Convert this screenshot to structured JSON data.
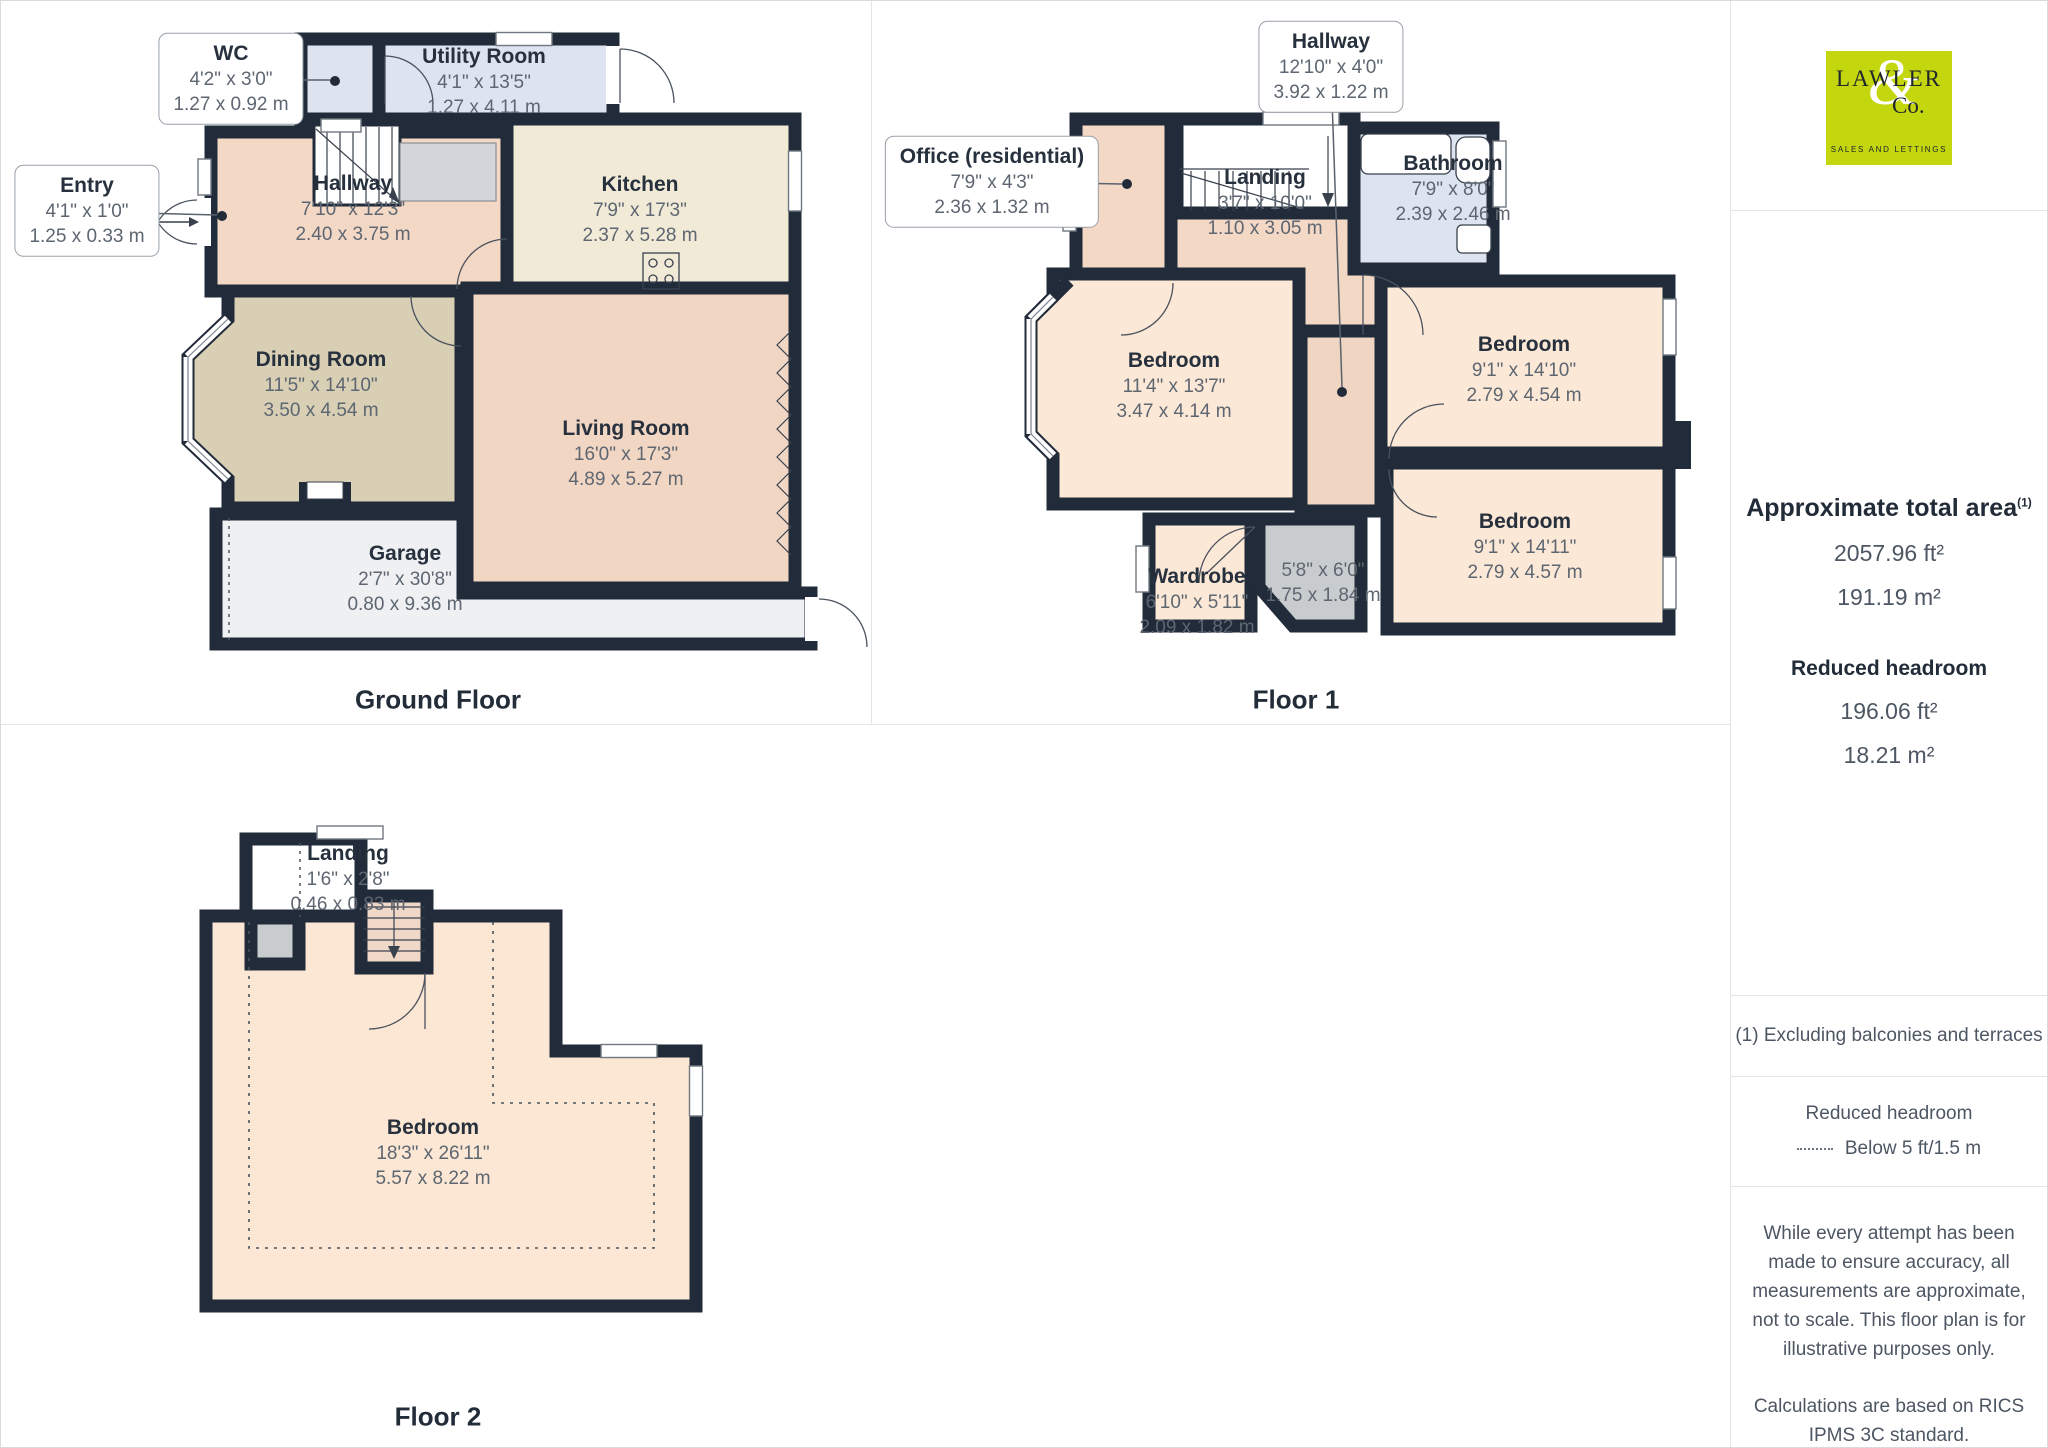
{
  "floors": [
    {
      "title": "Ground Floor",
      "rooms": [
        {
          "name": "WC",
          "imperial": "4'2\" x 3'0\"",
          "metric": "1.27 x 0.92 m"
        },
        {
          "name": "Utility Room",
          "imperial": "4'1\" x 13'5\"",
          "metric": "1.27 x 4.11 m"
        },
        {
          "name": "Entry",
          "imperial": "4'1\" x 1'0\"",
          "metric": "1.25 x 0.33 m"
        },
        {
          "name": "Hallway",
          "imperial": "7'10\" x 12'3\"",
          "metric": "2.40 x 3.75 m"
        },
        {
          "name": "Kitchen",
          "imperial": "7'9\" x 17'3\"",
          "metric": "2.37 x 5.28 m"
        },
        {
          "name": "Dining Room",
          "imperial": "11'5\" x 14'10\"",
          "metric": "3.50 x 4.54 m"
        },
        {
          "name": "Living Room",
          "imperial": "16'0\" x 17'3\"",
          "metric": "4.89 x 5.27 m"
        },
        {
          "name": "Garage",
          "imperial": "2'7\" x 30'8\"",
          "metric": "0.80 x 9.36 m"
        }
      ]
    },
    {
      "title": "Floor 1",
      "rooms": [
        {
          "name": "Hallway",
          "imperial": "12'10\" x 4'0\"",
          "metric": "3.92 x 1.22 m"
        },
        {
          "name": "Office (residential)",
          "imperial": "7'9\" x 4'3\"",
          "metric": "2.36 x 1.32 m"
        },
        {
          "name": "Landing",
          "imperial": "3'7\" x 10'0\"",
          "metric": "1.10 x 3.05 m"
        },
        {
          "name": "Bathroom",
          "imperial": "7'9\" x 8'0\"",
          "metric": "2.39 x 2.46 m"
        },
        {
          "name": "Bedroom",
          "imperial": "11'4\" x 13'7\"",
          "metric": "3.47 x 4.14 m"
        },
        {
          "name": "Bedroom",
          "imperial": "9'1\" x 14'10\"",
          "metric": "2.79 x 4.54 m"
        },
        {
          "name": "Bedroom",
          "imperial": "9'1\" x 14'11\"",
          "metric": "2.79 x 4.57 m"
        },
        {
          "name": "Wardrobe",
          "imperial": "6'10\" x 5'11\"",
          "metric": "2.09 x 1.82 m"
        },
        {
          "name": "",
          "imperial": "5'8\" x 6'0\"",
          "metric": "1.75 x 1.84 m"
        }
      ]
    },
    {
      "title": "Floor 2",
      "rooms": [
        {
          "name": "Landing",
          "imperial": "1'6\" x 2'8\"",
          "metric": "0.46 x 0.83 m"
        },
        {
          "name": "Bedroom",
          "imperial": "18'3\" x 26'11\"",
          "metric": "5.57 x 8.22 m"
        }
      ]
    }
  ],
  "sidebar": {
    "logo": {
      "word": "LAWLER",
      "ampersand": "&",
      "word2": "Co.",
      "tagline": "SALES AND LETTINGS",
      "background": "#c4d60e"
    },
    "area": {
      "title": "Approximate total area",
      "footnote_marker": "(1)",
      "total_ft": "2057.96 ft²",
      "total_m": "191.19 m²",
      "reduced_title": "Reduced headroom",
      "reduced_ft": "196.06 ft²",
      "reduced_m": "18.21 m²"
    },
    "footnote": "(1) Excluding balconies and terraces",
    "legend": {
      "title": "Reduced headroom",
      "item": "Below 5 ft/1.5 m"
    },
    "disclaimer_1": "While every attempt has been made to ensure accuracy, all measurements are approximate, not to scale. This floor plan is for illustrative purposes only.",
    "disclaimer_2": "Calculations are based on RICS IPMS 3C standard.",
    "brand": {
      "name": "GIRAFFE",
      "suffix": "360"
    }
  },
  "colors": {
    "wall": "#212b39",
    "room_peach": "#f3d8c6",
    "room_peach_light": "#fce8d6",
    "room_tan": "#d8cfb4",
    "room_cream": "#f1ead7",
    "room_blue": "#dde3ef",
    "garage_gray": "#eef0f2",
    "small_gray": "#c9ccce",
    "logo_lime": "#c4d60e"
  }
}
